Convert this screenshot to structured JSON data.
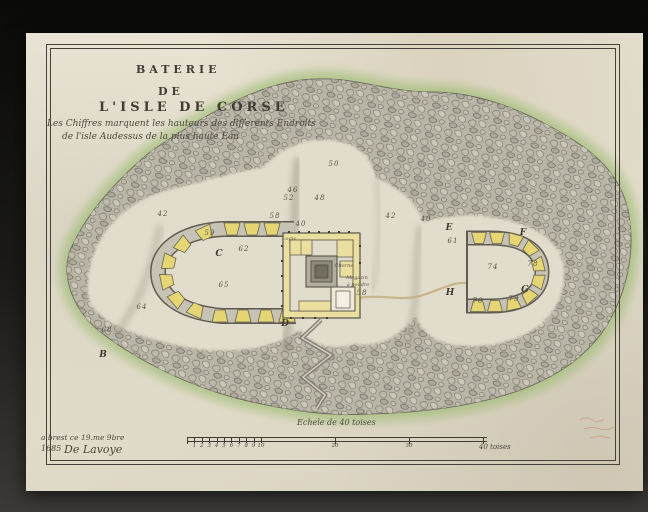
{
  "document": {
    "type": "manuscript-plan",
    "title_block": {
      "line1": "BATERIE",
      "line2": "DE",
      "line3": "L'ISLE  DE  CORSE",
      "subtitle_line1": "Les Chiffres marquent les hauteurs des differents Endroits",
      "subtitle_line2": "de l'isle Audessus de la plus haute Eau"
    },
    "signature": {
      "line1": "a brest ce 19.me 9bre",
      "line2": "1685",
      "line3": "De Lavoye"
    },
    "scale": {
      "label": "Echele de 40 toises",
      "minor_ticks": [
        "1",
        "2",
        "3",
        "4",
        "5",
        "6",
        "7",
        "8",
        "9",
        "10"
      ],
      "major_ticks": [
        "20",
        "30"
      ],
      "end_label": "40 toises"
    },
    "map": {
      "reference_letters": [
        {
          "label": "B",
          "x": 103,
          "y": 355
        },
        {
          "label": "C",
          "x": 219,
          "y": 254
        },
        {
          "label": "D",
          "x": 285,
          "y": 324
        },
        {
          "label": "E",
          "x": 449,
          "y": 228
        },
        {
          "label": "F",
          "x": 523,
          "y": 233
        },
        {
          "label": "G",
          "x": 525,
          "y": 290
        },
        {
          "label": "H",
          "x": 450,
          "y": 293
        }
      ],
      "spot_heights": [
        {
          "label": "50",
          "x": 334,
          "y": 164
        },
        {
          "label": "46",
          "x": 293,
          "y": 190
        },
        {
          "label": "52",
          "x": 289,
          "y": 198
        },
        {
          "label": "48",
          "x": 320,
          "y": 198
        },
        {
          "label": "58",
          "x": 275,
          "y": 216
        },
        {
          "label": "40",
          "x": 301,
          "y": 224
        },
        {
          "label": "42",
          "x": 163,
          "y": 214
        },
        {
          "label": "42",
          "x": 391,
          "y": 216
        },
        {
          "label": "40",
          "x": 426,
          "y": 219
        },
        {
          "label": "59",
          "x": 210,
          "y": 233
        },
        {
          "label": "62",
          "x": 244,
          "y": 249
        },
        {
          "label": "65",
          "x": 224,
          "y": 285
        },
        {
          "label": "64",
          "x": 142,
          "y": 307
        },
        {
          "label": "68",
          "x": 107,
          "y": 330
        },
        {
          "label": "61",
          "x": 453,
          "y": 241
        },
        {
          "label": "74",
          "x": 493,
          "y": 267
        },
        {
          "label": "78",
          "x": 533,
          "y": 264
        },
        {
          "label": "70",
          "x": 478,
          "y": 301
        },
        {
          "label": "79",
          "x": 514,
          "y": 299
        },
        {
          "label": "58",
          "x": 362,
          "y": 293
        }
      ],
      "structure_labels": [
        {
          "label": "Logis",
          "x": 289,
          "y": 239
        },
        {
          "label": "Citerne",
          "x": 344,
          "y": 266
        },
        {
          "label": "Magazin",
          "x": 357,
          "y": 278
        },
        {
          "label": "à poudre",
          "x": 358,
          "y": 285
        }
      ]
    },
    "colors": {
      "paper": "#e3decf",
      "backdrop": "#141312",
      "ink": "#46423a",
      "rock_gray": "#b9b5a7",
      "plateau": "#e1dccb",
      "green_wash": "#97b96b",
      "structure_yellow": "#e6d573"
    }
  }
}
